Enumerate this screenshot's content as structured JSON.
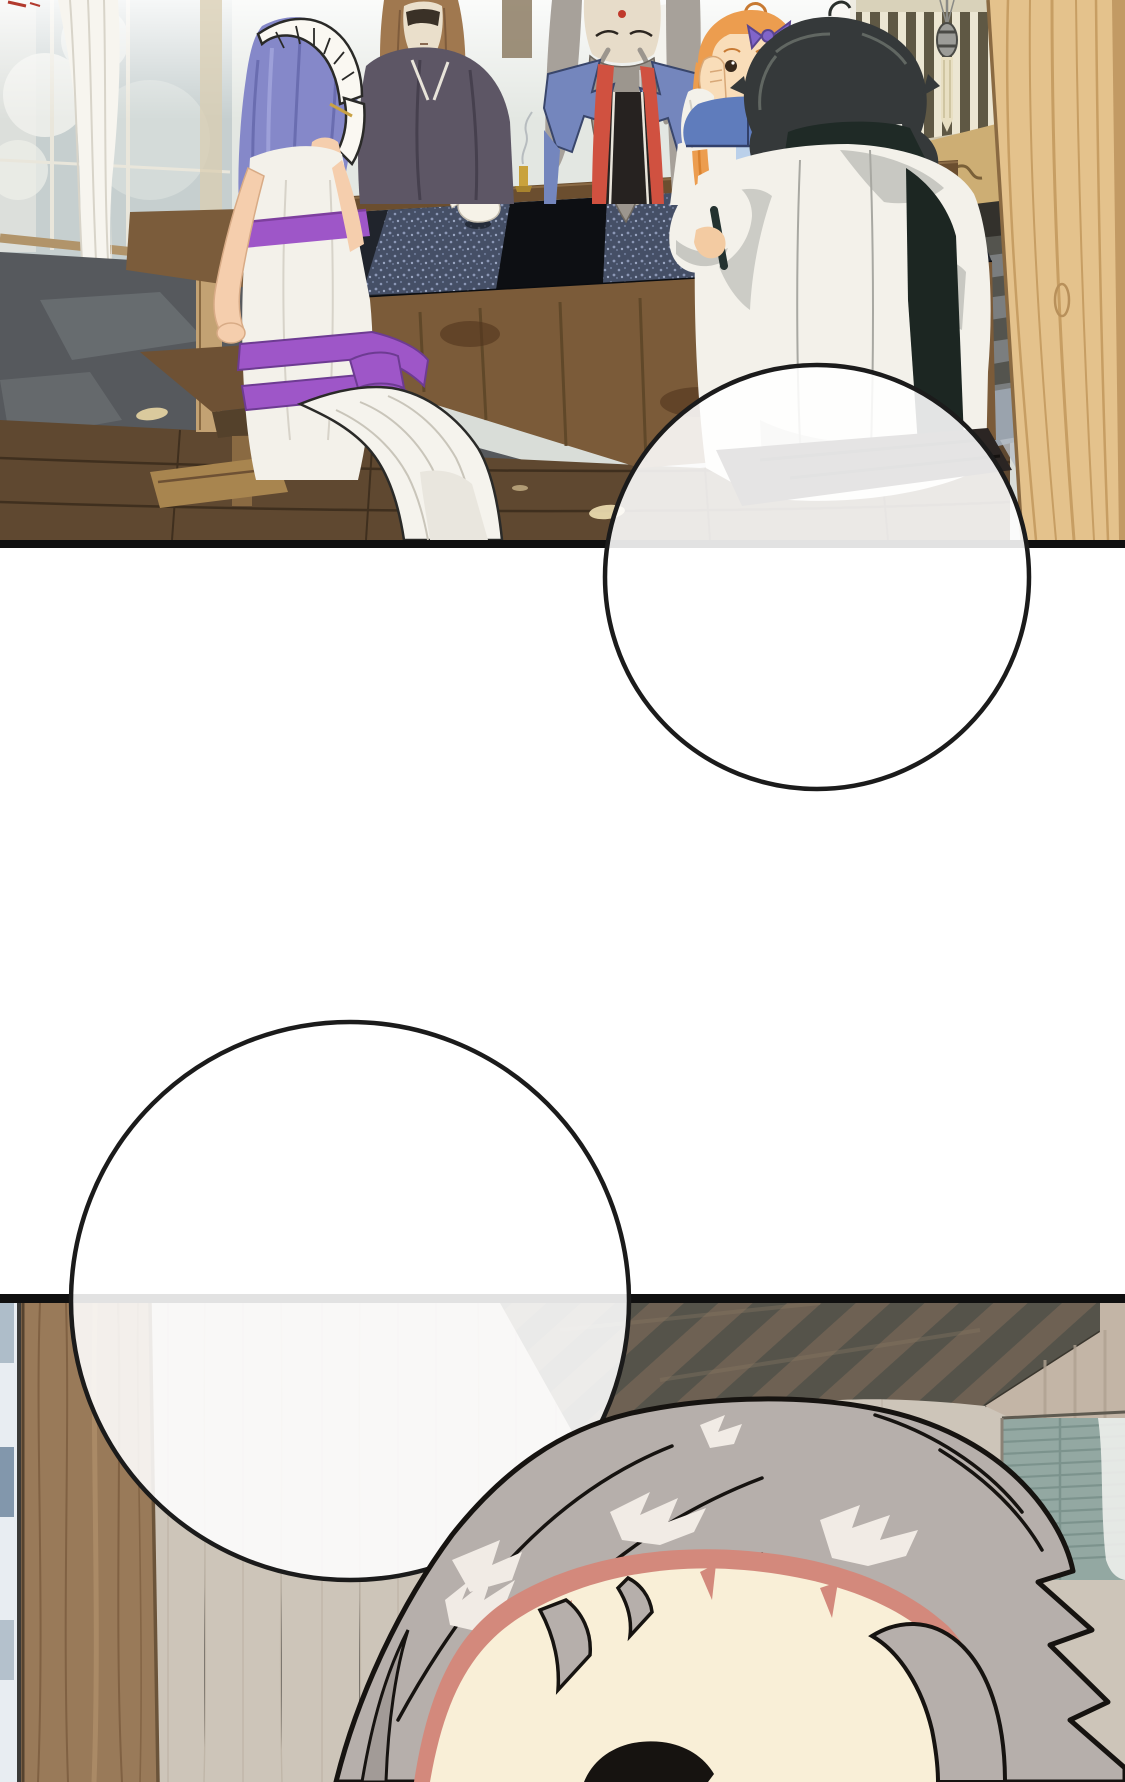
{
  "page": {
    "kind": "webtoon comic page",
    "width_px": 1125,
    "height_px": 1782,
    "background": "#ffffff"
  },
  "panels": [
    {
      "name": "panel-1",
      "label": "tea gathering scene",
      "description": "Five characters around a long dark tea table in a bright traditional room with windows, white curtains and a large wooden pillar on the right"
    },
    {
      "name": "panel-2",
      "label": "close-up scene",
      "description": "Top of a swept-back grey-haired head in front of a pale wooden wall, diagonally striped ceiling and teal blinds"
    }
  ],
  "characters": [
    {
      "name": "purple-haired-attendant",
      "position": "left foreground, seen from behind, white dress with purple bands and white headband"
    },
    {
      "name": "brown-haired-man",
      "position": "far side of table, left, dark robe"
    },
    {
      "name": "old-man-with-long-beard",
      "position": "far side of table, center, blue robe with red straps"
    },
    {
      "name": "orange-haired-girl",
      "position": "far side of table, hands on cheeks, blue collar"
    },
    {
      "name": "black-haired-boy",
      "position": "near side of table, right, white robe with black trim, seen from behind"
    },
    {
      "name": "grey-haired-person",
      "position": "bottom panel close-up of head, cream forehead"
    }
  ],
  "speech_bubbles": [
    {
      "name": "speech-bubble-1",
      "shape": "circle",
      "text": ""
    },
    {
      "name": "speech-bubble-2",
      "shape": "circle",
      "text": ""
    }
  ],
  "palette": {
    "page_bg": "#ffffff",
    "border": "#101010",
    "bubble_fill": "rgba(255,255,255,0.88)",
    "bubble_stroke": "#1b1b1b",
    "skin": "#f5cead",
    "purple_hair": "#8588c9",
    "purple_stripe": "#9e56c8",
    "orange_hair": "#ec9d4f",
    "black_hair": "#35393a",
    "silver_hair": "#b6afab",
    "grey_hair_old": "#a7a19a",
    "robe_white": "#f3f1ea",
    "robe_blue": "#7486bd",
    "strap_red": "#d05140",
    "collar_blue": "#5f7cbc",
    "robe_dark": "#5d5665",
    "pillar": "#e4c28c",
    "table_wood": "#7b5b39",
    "slate": "#56595d",
    "plank": "#5f4830",
    "beam": "#997a59",
    "wall": "#cdc5b9",
    "stripe_a": "#55534a",
    "stripe_b": "#6e6153",
    "blinds": "#93a8a2",
    "cream": "#f9efd7",
    "pink": "#d3897c"
  }
}
